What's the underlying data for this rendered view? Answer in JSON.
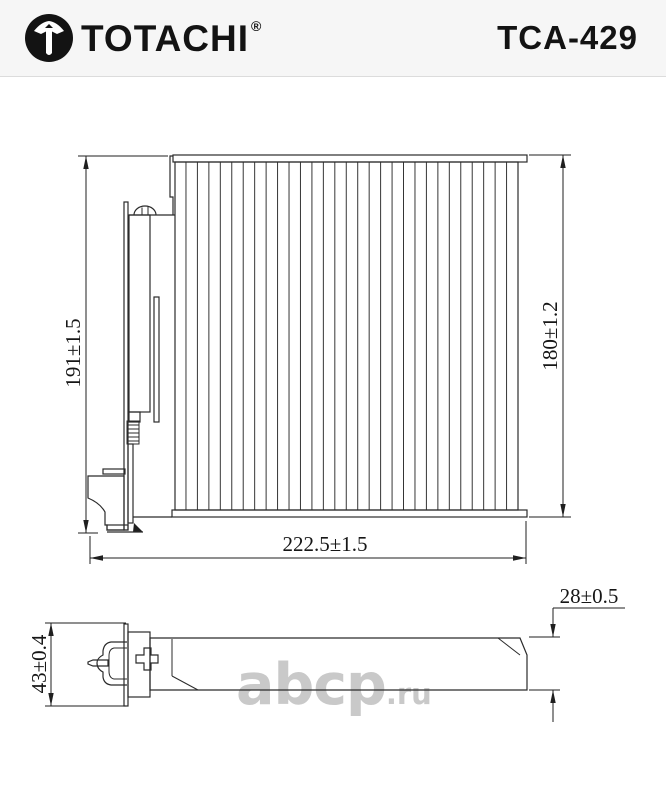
{
  "header": {
    "brand": "TOTACHI",
    "registered_mark": "®",
    "part_number": "TCA-429",
    "background": "#f6f6f6",
    "text_color": "#131313"
  },
  "watermark": {
    "text": "abcp",
    "suffix": ".ru",
    "color": "#c7c7c7"
  },
  "drawing": {
    "type": "cabin-air-filter technical drawing, front view and side view",
    "line_color": "#2b2b2b",
    "dimensions": {
      "front_height_left": "191±1.5",
      "front_height_right": "180±1.2",
      "front_width": "222.5±1.5",
      "side_thickness": "28±0.5",
      "side_height": "43±0.4"
    }
  }
}
